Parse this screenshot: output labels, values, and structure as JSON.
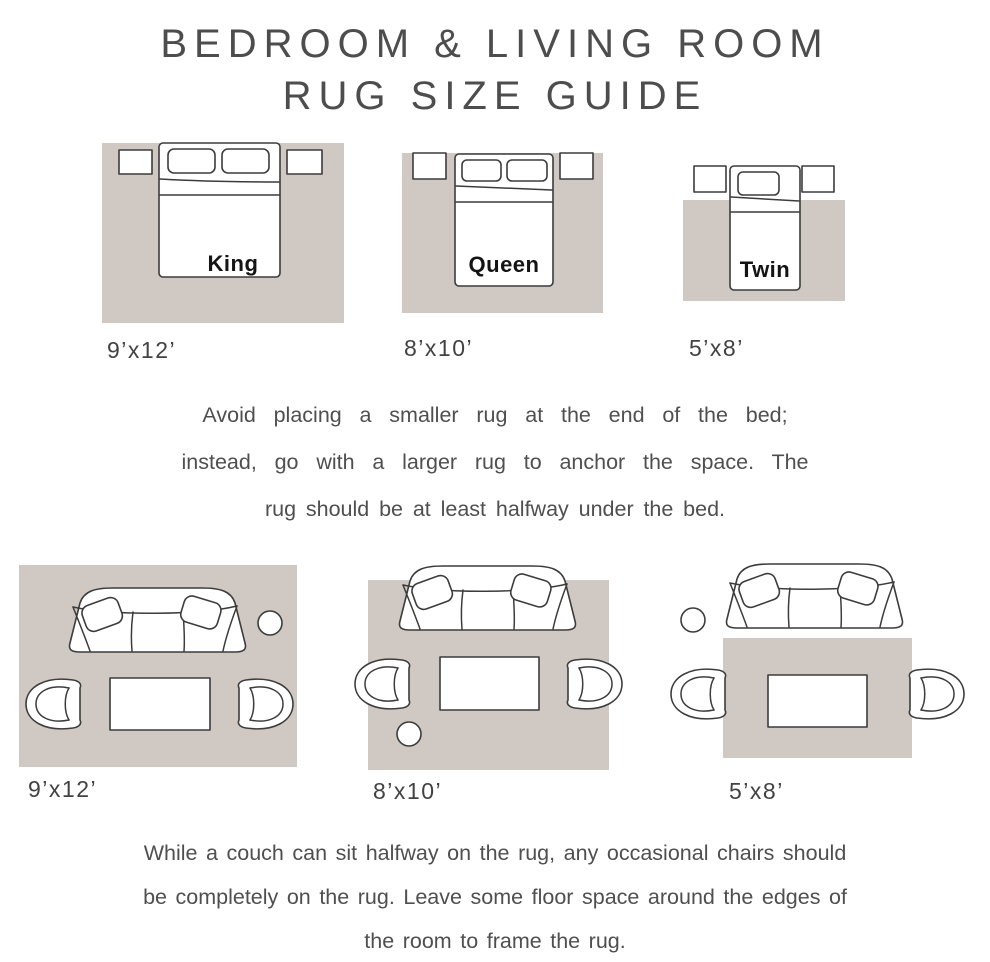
{
  "title": {
    "line1": "BEDROOM & LIVING ROOM",
    "line2": "RUG SIZE GUIDE"
  },
  "colors": {
    "rug": "#d0c8c3",
    "outline": "#3c3c3c",
    "heading_text": "#4d4d4d",
    "body_text": "#4f4f4f",
    "bed_label_text": "#141414"
  },
  "bedroom_section": {
    "diagrams": [
      {
        "bed_label": "King",
        "rug_size": "9’x12’"
      },
      {
        "bed_label": "Queen",
        "rug_size": "8’x10’"
      },
      {
        "bed_label": "Twin",
        "rug_size": "5’x8’"
      }
    ],
    "note_lines": [
      "Avoid placing a smaller rug at the end of the bed;",
      "instead, go with a larger rug to anchor the space. The",
      "rug should be at least halfway under the bed."
    ]
  },
  "living_room_section": {
    "diagrams": [
      {
        "rug_size": "9’x12’"
      },
      {
        "rug_size": "8’x10’"
      },
      {
        "rug_size": "5’x8’"
      }
    ],
    "note_lines": [
      "While a couch can sit halfway on the rug, any occasional chairs should",
      "be completely on the rug. Leave some floor space around the edges of",
      "the room to frame the rug."
    ]
  }
}
